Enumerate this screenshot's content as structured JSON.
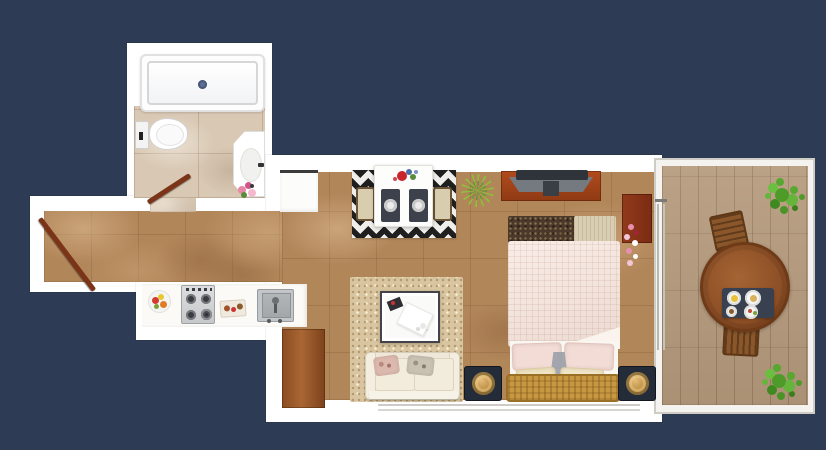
{
  "scene": {
    "type": "studio-apartment-floor-plan",
    "view": "top-down-3d-render",
    "background_color": "#2d3c54",
    "palette": {
      "wall": "#ffffff",
      "marble_floor": "#b18659",
      "bathroom_tile": "#d8c8b4",
      "balcony_wood": "#b59a7c",
      "chevron_rug_dark": "#1f1f1f",
      "chevron_rug_light": "#efeeea",
      "area_rug": "#d9c6a1",
      "sofa": "#efe8d8",
      "bed_blanket": "#f6e3da",
      "wicker_bench": "#c79742",
      "tv_stand": "#a8441c",
      "wood_cabinet": "#8a4c20",
      "balcony_table": "#8d4f26",
      "plant_green": "#57a230",
      "pouf_base": "#242c3a",
      "pouf_gold": "#b98a3e",
      "door_leaf": "#7b3418"
    },
    "rooms": [
      {
        "name": "bathroom",
        "items": [
          "bathtub",
          "toilet",
          "corner-sink",
          "flowers",
          "swing-door"
        ]
      },
      {
        "name": "hallway",
        "items": [
          "entry-door"
        ]
      },
      {
        "name": "kitchen",
        "items": [
          "countertop",
          "fruit-bowl",
          "gas-stove",
          "cutting-board",
          "kitchen-sink",
          "wood-cabinet"
        ]
      },
      {
        "name": "living-room",
        "items": [
          "chevron-rug",
          "dining-table",
          "dining-chair-left",
          "dining-chair-right",
          "placemats",
          "flower-bouquet",
          "spiky-plant",
          "area-rug",
          "coffee-table",
          "sofa",
          "throw-pillows"
        ]
      },
      {
        "name": "bedroom",
        "items": [
          "tv-stand",
          "tv",
          "double-bed",
          "foot-blanket",
          "pillows",
          "wicker-bench",
          "lamp",
          "pouf-left",
          "pouf-right",
          "nightstand",
          "flowers"
        ]
      },
      {
        "name": "balcony",
        "items": [
          "round-table",
          "wicker-chair-top",
          "wicker-chair-bottom",
          "serving-tray",
          "plates",
          "plant-top",
          "plant-bottom"
        ]
      }
    ]
  }
}
